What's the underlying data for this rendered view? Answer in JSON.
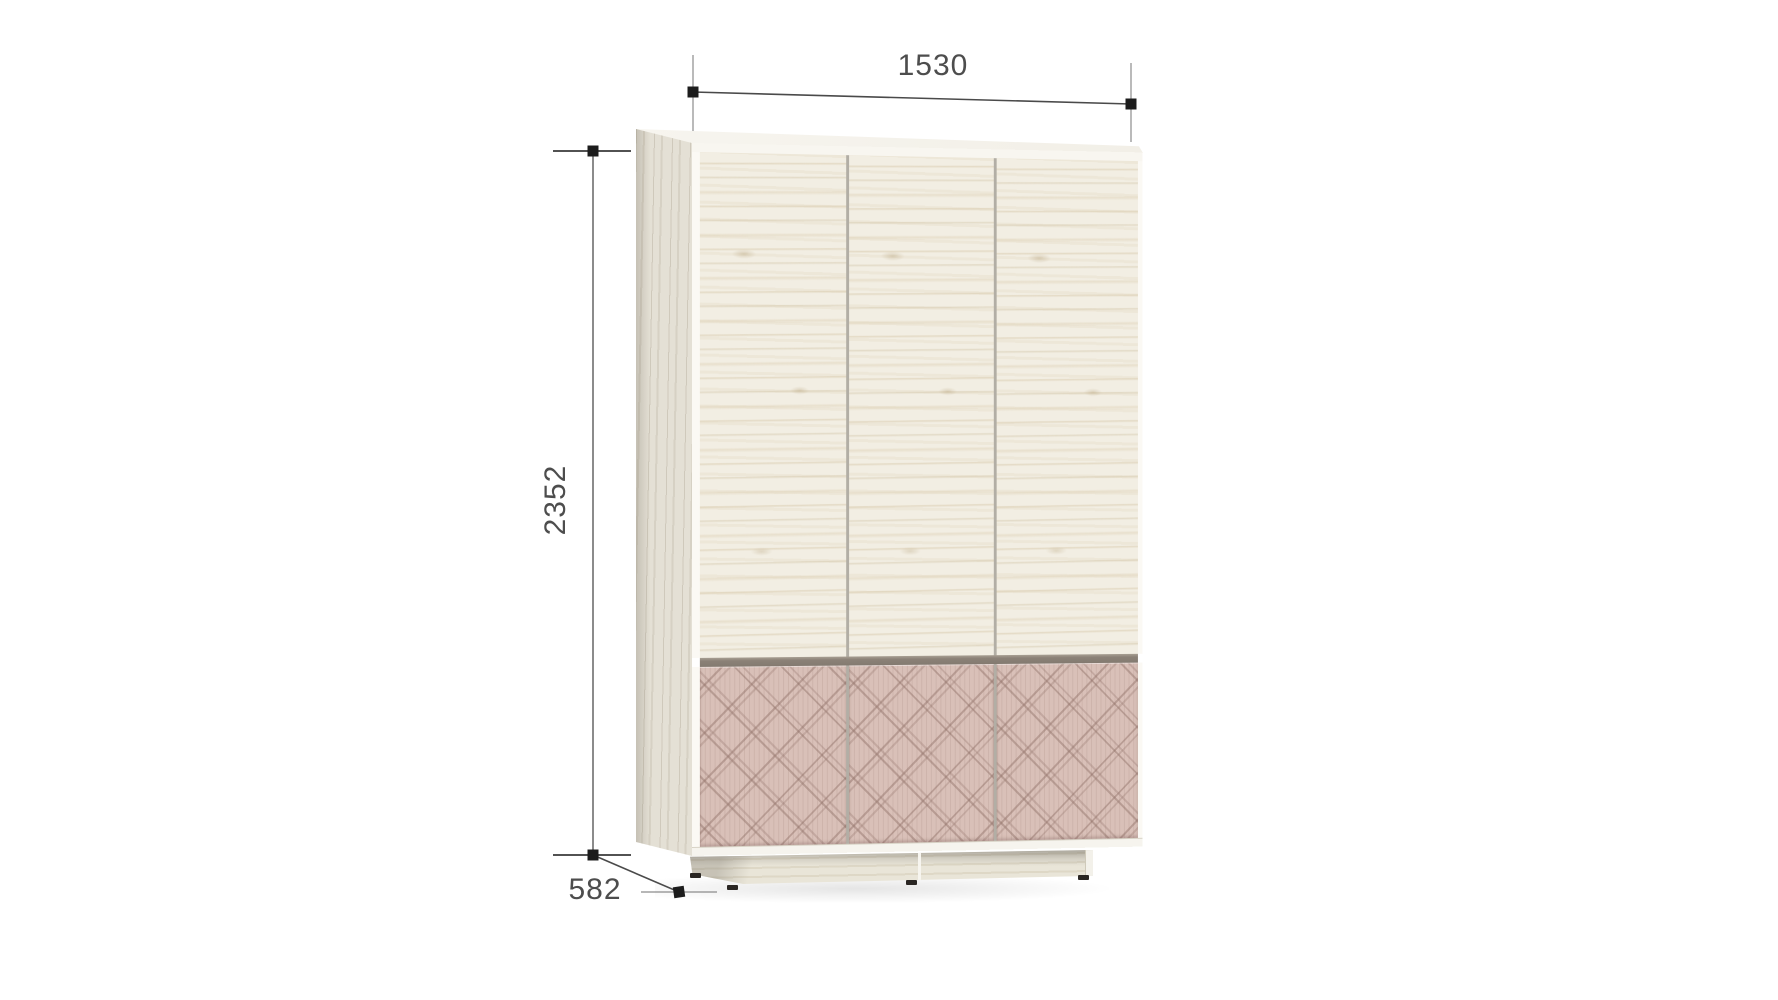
{
  "page": {
    "background": "#ffffff"
  },
  "dimensions": {
    "width": {
      "label": "1530"
    },
    "height": {
      "label": "2352"
    },
    "depth": {
      "label": "582"
    }
  },
  "wardrobe": {
    "doors_count": 3,
    "drawer_panels_count": 3,
    "colors": {
      "door_wood": "#f2eee3",
      "side_panel_wood": "#e4e0d5",
      "drawer_front_pink": "#d9c0b8",
      "divider_strip": "#8b8177",
      "plinth_wood": "#e9e5d8",
      "edge_white": "#f8f6f0",
      "feet": "#2a2623"
    }
  },
  "annotation": {
    "line_color": "#4a4a4a",
    "tick_color": "#8c8c8c",
    "marker_color": "#1c1c1c",
    "text_color": "#4d4d4d"
  }
}
